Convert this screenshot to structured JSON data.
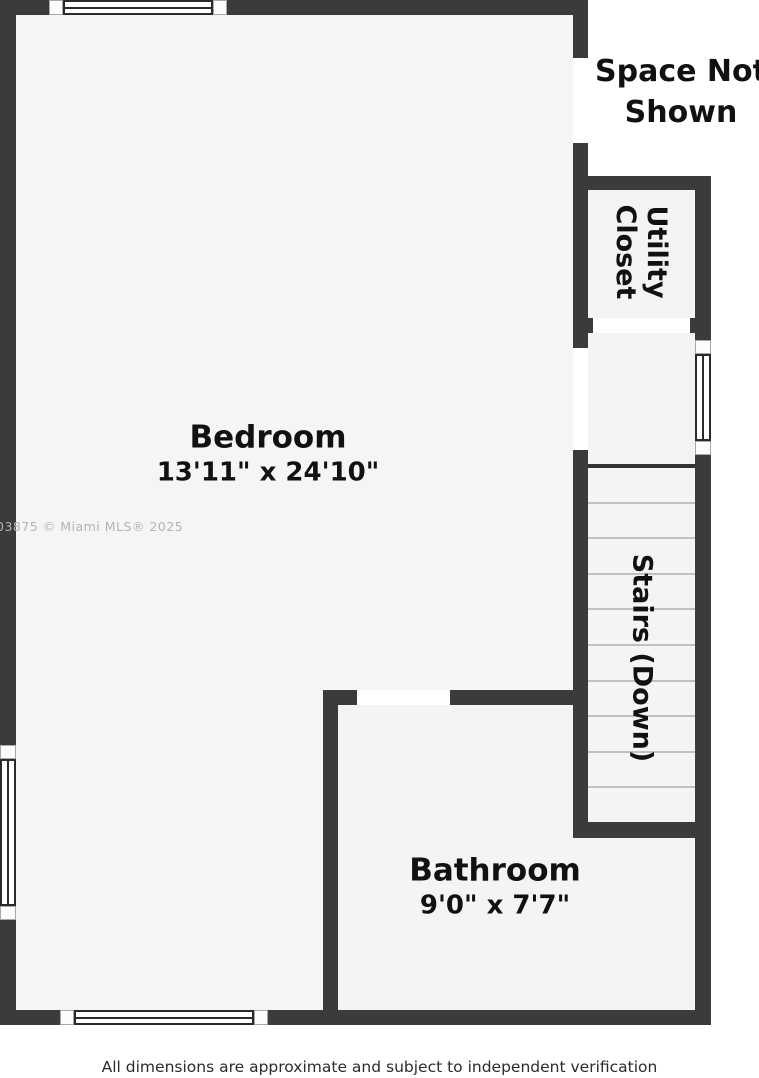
{
  "rooms": {
    "bedroom": {
      "label": "Bedroom",
      "dims": "13'11\" x 24'10\""
    },
    "bathroom": {
      "label": "Bathroom",
      "dims": "9'0\" x 7'7\""
    },
    "utility_closet": {
      "label": "Utility Closet"
    },
    "stairs": {
      "label": "Stairs (Down)"
    }
  },
  "annotations": {
    "space_not_shown": "Space Not Shown",
    "watermark": "03875 © Miami MLS® 2025",
    "footer": "All dimensions are approximate and subject to independent verification"
  },
  "icons": {
    "window": "window-symbol",
    "door_opening": "door-opening-symbol",
    "stair_treads": "stair-treads-symbol"
  },
  "colors": {
    "wall": "#3b3b3b",
    "floor": "#f5f5f5",
    "background": "#ffffff",
    "label_text": "#111111",
    "tread_line": "#c0c0c0",
    "watermark": "#b3b3b3",
    "footer_text": "#2b2b2b"
  }
}
